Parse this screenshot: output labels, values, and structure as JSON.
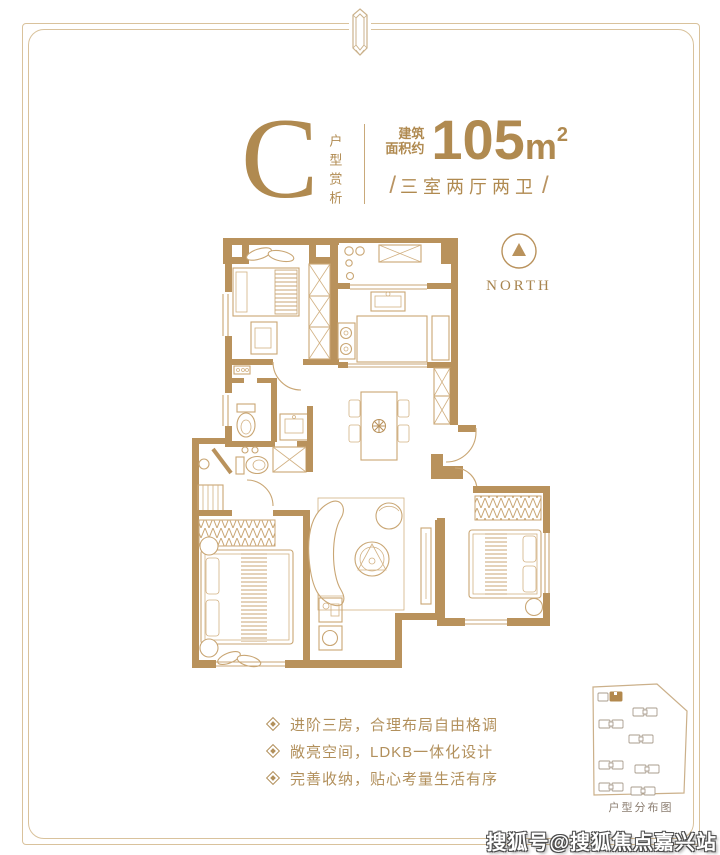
{
  "colors": {
    "accent": "#b08a50",
    "wall": "#b9925c",
    "thin_line": "#c9a674",
    "frame": "#d9c29c"
  },
  "header": {
    "unit_letter": "C",
    "unit_label_vertical": "户型赏析",
    "area_prefix_line1": "建筑",
    "area_prefix_line2": "面积约",
    "area_value": "105",
    "area_unit": "m",
    "area_unit_sup": "2",
    "slash_left": "/",
    "layout_text": "三室两厅两卫",
    "slash_right": "/"
  },
  "compass": {
    "label": "NORTH"
  },
  "features": [
    {
      "text": "进阶三房，合理布局自由格调"
    },
    {
      "text": "敞亮空间，LDKB一体化设计"
    },
    {
      "text": "完善收纳，贴心考量生活有序"
    }
  ],
  "site_plan": {
    "caption": "户型分布图"
  },
  "watermark": {
    "text": "搜狐号@搜狐焦点嘉兴站"
  }
}
